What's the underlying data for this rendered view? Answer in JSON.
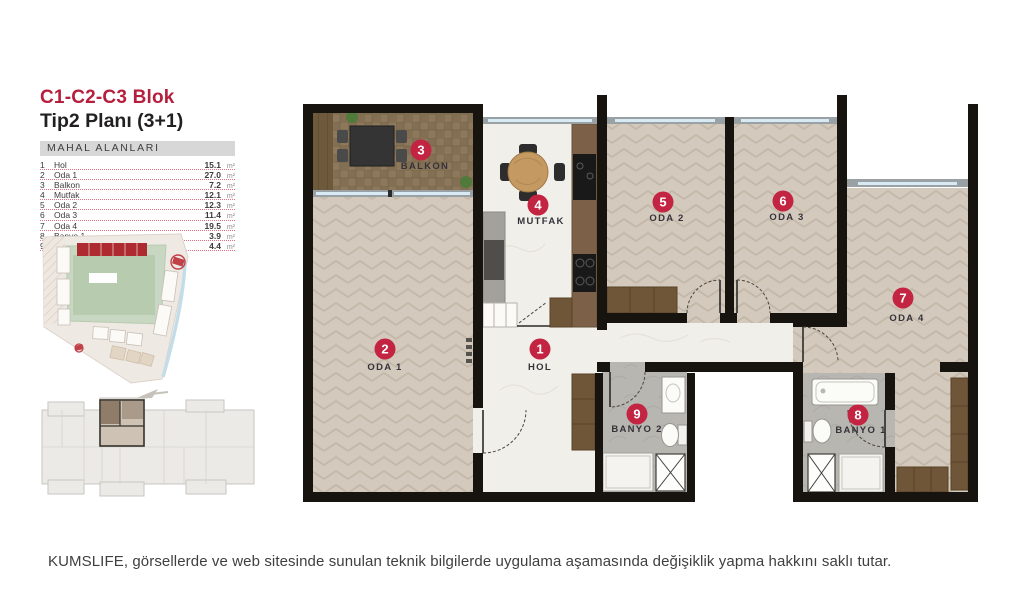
{
  "header": {
    "block_title": "C1-C2-C3 Blok",
    "plan_title": "Tip2 Planı (3+1)"
  },
  "areas_table": {
    "header": "MAHAL ALANLARI",
    "unit": "m²",
    "rows": [
      {
        "no": "1",
        "name": "Hol",
        "value": "15.1"
      },
      {
        "no": "2",
        "name": "Oda 1",
        "value": "27.0"
      },
      {
        "no": "3",
        "name": "Balkon",
        "value": "7.2"
      },
      {
        "no": "4",
        "name": "Mutfak",
        "value": "12.1"
      },
      {
        "no": "5",
        "name": "Oda 2",
        "value": "12.3"
      },
      {
        "no": "6",
        "name": "Oda 3",
        "value": "11.4"
      },
      {
        "no": "7",
        "name": "Oda 4",
        "value": "19.5"
      },
      {
        "no": "8",
        "name": "Banyo 1",
        "value": "3.9"
      },
      {
        "no": "9",
        "name": "Banyo 2",
        "value": "4.4"
      }
    ]
  },
  "plan": {
    "rooms": [
      {
        "no": "1",
        "label": "HOL"
      },
      {
        "no": "2",
        "label": "ODA 1"
      },
      {
        "no": "3",
        "label": "BALKON"
      },
      {
        "no": "4",
        "label": "MUTFAK"
      },
      {
        "no": "5",
        "label": "ODA 2"
      },
      {
        "no": "6",
        "label": "ODA 3"
      },
      {
        "no": "7",
        "label": "ODA 4"
      },
      {
        "no": "8",
        "label": "BANYO 1"
      },
      {
        "no": "9",
        "label": "BANYO 2"
      }
    ]
  },
  "footer": {
    "disclaimer": "KUMSLIFE, görsellerde ve web sitesinde sunulan teknik bilgilerde uygulama aşamasında değişiklik yapma hakkını saklı tutar."
  },
  "colors": {
    "brand_red": "#b51f3d",
    "badge_red": "#c22442",
    "wall_black": "#17140f",
    "herringbone_floor": "#d3c9bc",
    "balcony_deck": "#8d785c",
    "marble_floor": "#f0efe9",
    "bath_tile": "#b8b6b0",
    "furniture_wood": "#6f5639"
  }
}
